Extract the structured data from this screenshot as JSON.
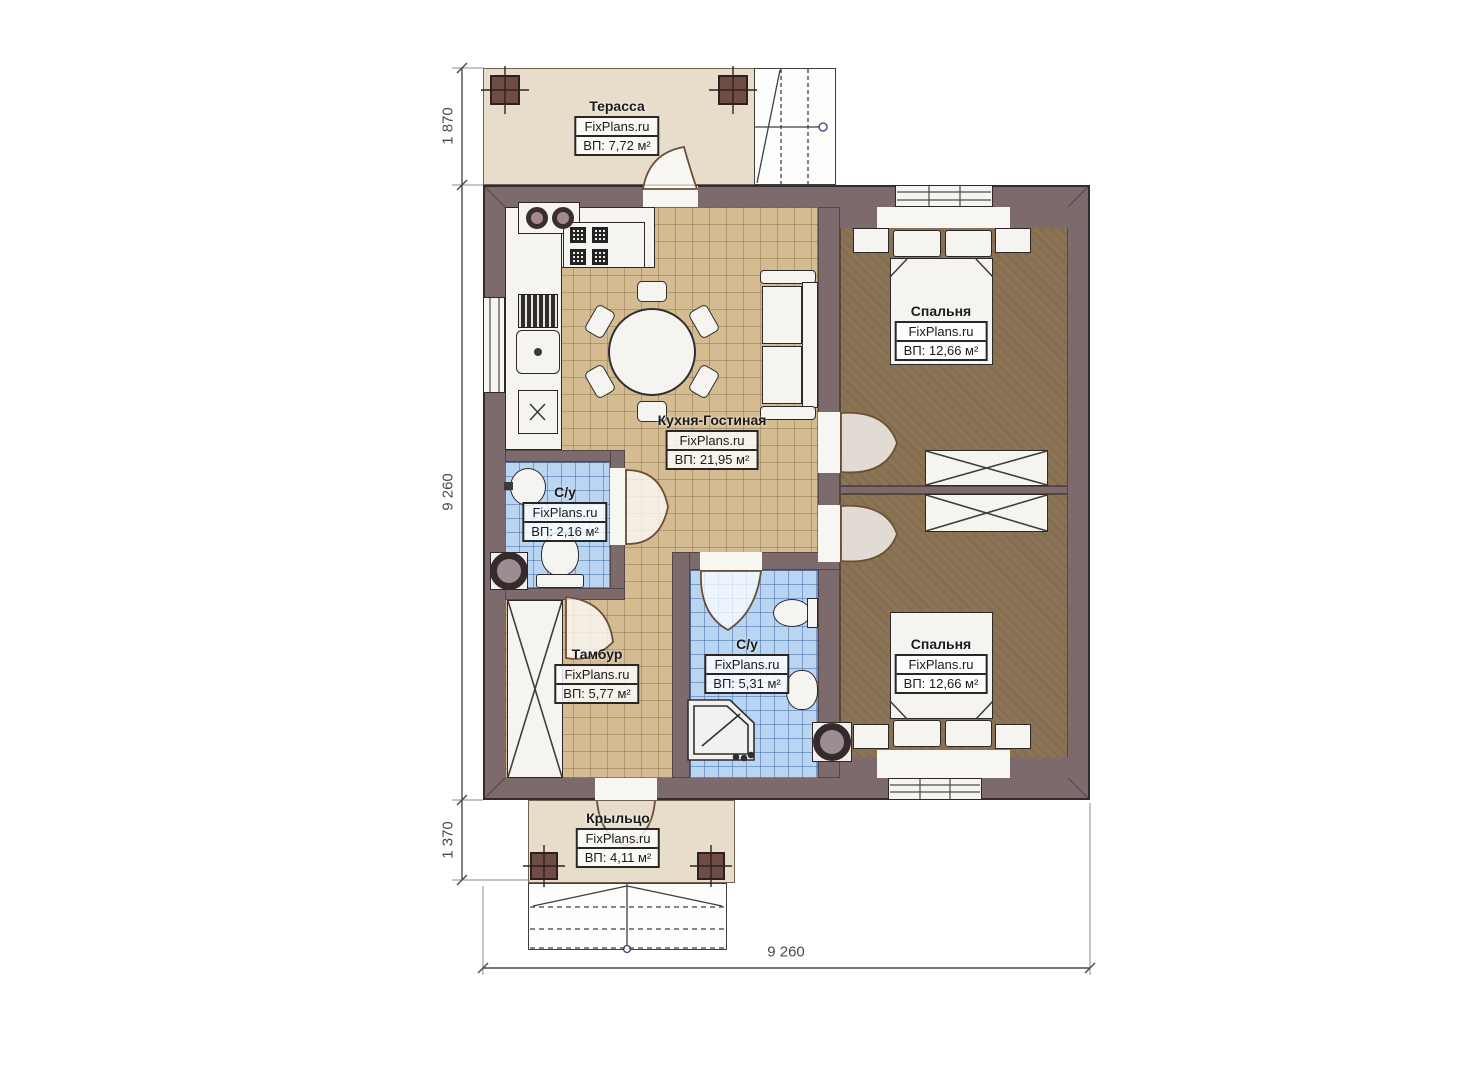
{
  "watermark": "FixPlans.ru",
  "rooms": [
    {
      "id": "terrace",
      "name": "Терасса",
      "area": "ВП: 7,72 м²"
    },
    {
      "id": "kitchen-living",
      "name": "Кухня-Гостиная",
      "area": "ВП: 21,95 м²"
    },
    {
      "id": "bedroom-top",
      "name": "Спальня",
      "area": "ВП: 12,66 м²"
    },
    {
      "id": "bedroom-bottom",
      "name": "Спальня",
      "area": "ВП: 12,66 м²"
    },
    {
      "id": "bathroom-small",
      "name": "С/у",
      "area": "ВП: 2,16 м²"
    },
    {
      "id": "bathroom-big",
      "name": "С/у",
      "area": "ВП: 5,31 м²"
    },
    {
      "id": "vestibule",
      "name": "Тамбур",
      "area": "ВП: 5,77 м²"
    },
    {
      "id": "porch",
      "name": "Крыльцо",
      "area": "ВП: 4,11 м²"
    }
  ],
  "dimensions": {
    "top_left": "1 870",
    "left": "9 260",
    "bottom_left": "1 370",
    "bottom": "9 260"
  },
  "colors": {
    "wall": "#7d6a6c",
    "terrace_floor": "#e7ddca",
    "kitchen_tile": "#d4bb92",
    "bedroom_floor": "#8b7355",
    "bathroom_tile": "#b9d5f1",
    "post": "#6f4c44"
  }
}
